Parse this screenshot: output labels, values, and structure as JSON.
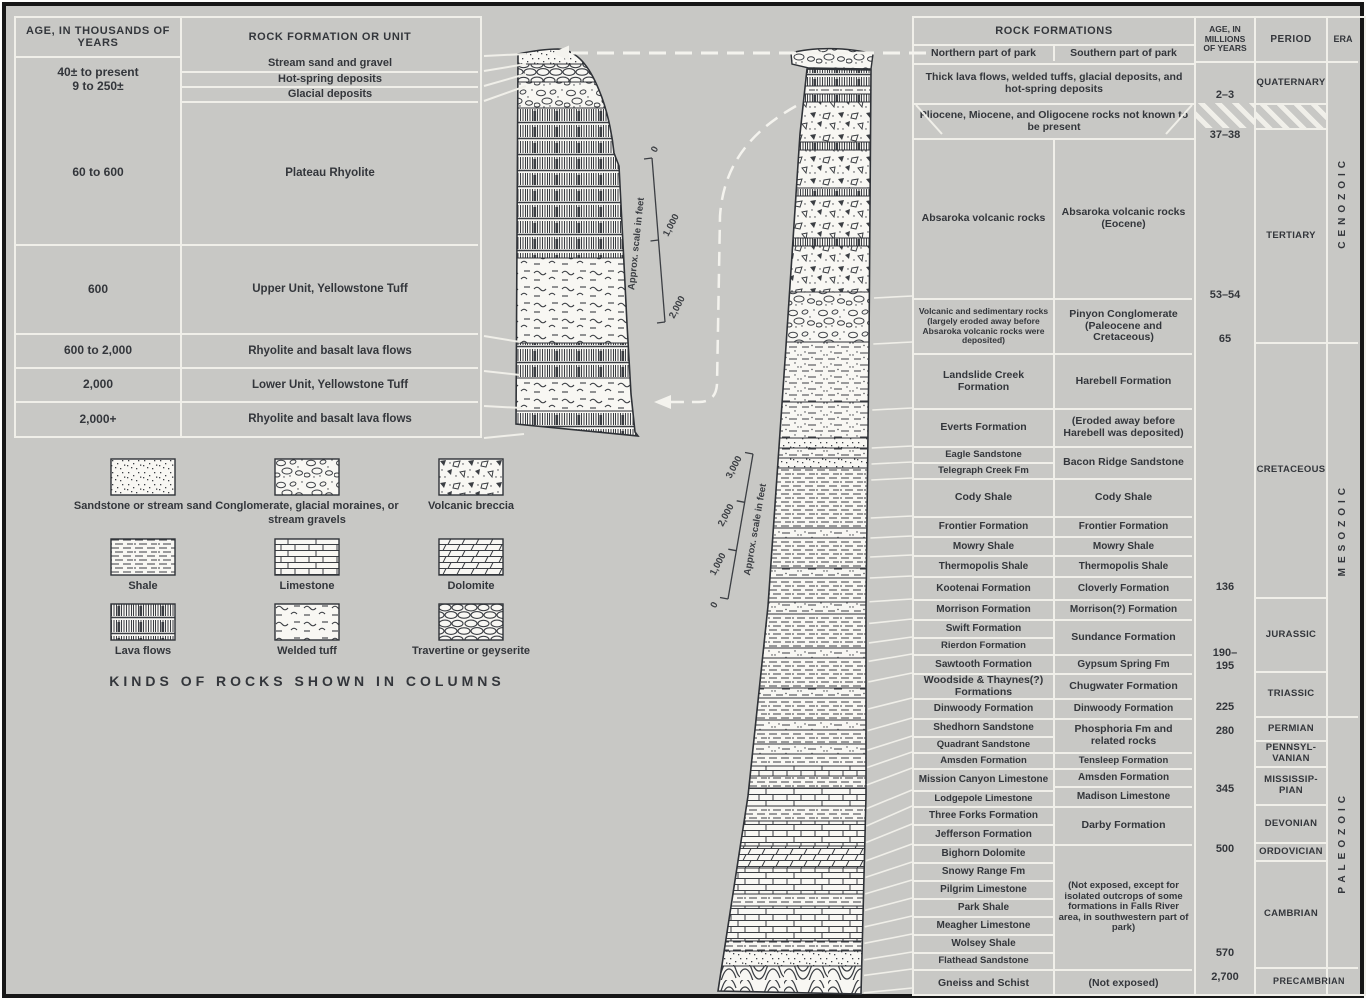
{
  "figure": {
    "paper_color": "#c8c8c5",
    "line_color": "#f0efe9",
    "ink_color": "#33363b"
  },
  "left_table": {
    "header_age": "AGE, IN THOUSANDS OF YEARS",
    "header_rock": "ROCK FORMATION OR UNIT",
    "age_span_line1": "40± to present",
    "age_span_line2": "9 to 250±",
    "top_rocks": [
      "Stream sand and gravel",
      "Hot-spring deposits",
      "Glacial deposits"
    ],
    "ages": [
      "60 to 600",
      "600",
      "600 to 2,000",
      "2,000",
      "2,000+"
    ],
    "rocks": [
      "Plateau Rhyolite",
      "Upper Unit, Yellowstone Tuff",
      "Rhyolite and basalt lava flows",
      "Lower Unit, Yellowstone Tuff",
      "Rhyolite and basalt lava flows"
    ]
  },
  "right_table": {
    "header": "ROCK FORMATIONS",
    "col_north": "Northern part of park",
    "col_south": "Southern part of park",
    "header_age": "AGE, IN MILLIONS OF YEARS",
    "header_period": "PERIOD",
    "header_era": "ERA",
    "span_quaternary": "Thick lava flows, welded tuffs, glacial deposits, and hot-spring deposits",
    "span_gap": "Pliocene, Miocene, and Oligocene rocks not known to be present",
    "north": [
      "Absaroka volcanic rocks",
      "Volcanic and sedimentary rocks (largely eroded away before Absaroka volcanic rocks were deposited)",
      "Landslide Creek Formation",
      "Everts Formation",
      "Eagle Sandstone",
      "Telegraph Creek Fm",
      "Cody Shale",
      "Frontier Formation",
      "Mowry Shale",
      "Thermopolis Shale",
      "Kootenai Formation",
      "Morrison Formation",
      "Swift Formation",
      "Rierdon Formation",
      "Sawtooth Formation",
      "Woodside & Thaynes(?) Formations",
      "Dinwoody Formation",
      "Shedhorn Sandstone",
      "Quadrant Sandstone",
      "Amsden Formation",
      "Mission Canyon Limestone",
      "Lodgepole Limestone",
      "Three Forks Formation",
      "Jefferson Formation",
      "Bighorn Dolomite",
      "Snowy Range Fm",
      "Pilgrim Limestone",
      "Park Shale",
      "Meagher Limestone",
      "Wolsey Shale",
      "Flathead Sandstone",
      "Gneiss and Schist"
    ],
    "south": [
      "Absaroka volcanic rocks (Eocene)",
      "Pinyon Conglomerate (Paleocene and Cretaceous)",
      "Harebell Formation",
      "(Eroded away before Harebell was deposited)",
      "Bacon Ridge Sandstone",
      "Cody Shale",
      "Frontier Formation",
      "Mowry Shale",
      "Thermopolis Shale",
      "Cloverly Formation",
      "Morrison(?) Formation",
      "Sundance Formation",
      "Gypsum Spring Fm",
      "Chugwater Formation",
      "Dinwoody Formation",
      "Phosphoria Fm and related rocks",
      "Tensleep Formation",
      "Amsden Formation",
      "Madison Limestone",
      "Darby Formation",
      "(Not exposed, except for isolated outcrops of some formations in Falls River area, in southwestern part of park)",
      "(Not exposed)"
    ],
    "ages": [
      "2–3",
      "37–38",
      "53–54",
      "65",
      "136",
      "190–",
      "195",
      "225",
      "280",
      "345",
      "500",
      "570",
      "2,700"
    ],
    "periods": [
      "QUATERNARY",
      "TERTIARY",
      "CRETACEOUS",
      "JURASSIC",
      "TRIASSIC",
      "PERMIAN",
      "PENNSYL-VANIAN",
      "MISSISSIP-PIAN",
      "DEVONIAN",
      "ORDOVICIAN",
      "CAMBRIAN",
      "PRECAMBRIAN"
    ],
    "eras": [
      "CENOZOIC",
      "MESOZOIC",
      "PALEOZOIC"
    ]
  },
  "legend": {
    "title": "KINDS OF ROCKS SHOWN IN COLUMNS",
    "items": [
      {
        "label": "Sandstone or stream sand",
        "pattern": "sand"
      },
      {
        "label": "Conglomerate, glacial moraines, or stream gravels",
        "pattern": "congl"
      },
      {
        "label": "Volcanic breccia",
        "pattern": "breccia"
      },
      {
        "label": "Shale",
        "pattern": "shale"
      },
      {
        "label": "Limestone",
        "pattern": "limestone"
      },
      {
        "label": "Dolomite",
        "pattern": "dolomite"
      },
      {
        "label": "Lava flows",
        "pattern": "lava"
      },
      {
        "label": "Welded tuff",
        "pattern": "tuff"
      },
      {
        "label": "Travertine or geyserite",
        "pattern": "trav"
      }
    ]
  },
  "scales": {
    "left": {
      "caption": "Approx. scale in feet",
      "ticks": [
        "0",
        "1,000",
        "2,000"
      ]
    },
    "right": {
      "caption": "Approx. scale in feet",
      "ticks": [
        "0",
        "1,000",
        "2,000",
        "3,000"
      ]
    }
  }
}
